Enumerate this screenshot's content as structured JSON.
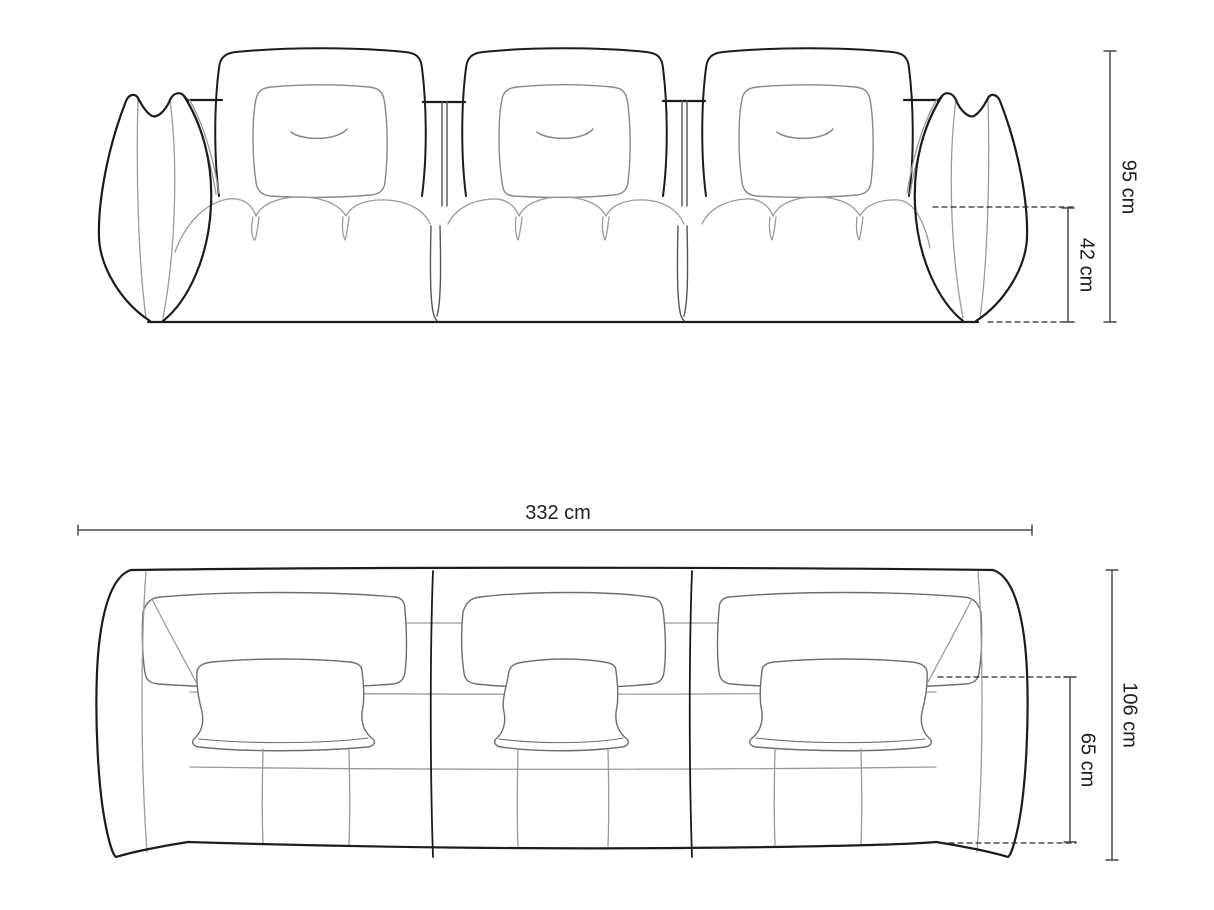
{
  "diagram": {
    "subject": "three-seater modular sofa technical drawing",
    "views": {
      "front": {
        "name": "front elevation view",
        "modules": 3,
        "back_cushions": 3,
        "throw_pillows": 3
      },
      "top": {
        "name": "top plan view",
        "modules": 3,
        "back_cushions": 3,
        "throw_pillows": 3
      }
    },
    "dimensions": {
      "total_height": {
        "label": "95 cm",
        "applies_to": "front view overall height"
      },
      "seat_height": {
        "label": "42 cm",
        "applies_to": "front view seat height"
      },
      "total_width": {
        "label": "332 cm",
        "applies_to": "top view overall width"
      },
      "total_depth": {
        "label": "106 cm",
        "applies_to": "top view overall depth"
      },
      "seat_depth": {
        "label": "65 cm",
        "applies_to": "top view seat depth"
      }
    },
    "colors": {
      "outline": "#1c1c1c",
      "seam": "#9b9b9b",
      "detail": "#6e6e6e",
      "dimension_line": "#4a4a4a",
      "dashed_line": "#2a2a2a",
      "text": "#1f1f1f",
      "background": "#ffffff"
    }
  }
}
